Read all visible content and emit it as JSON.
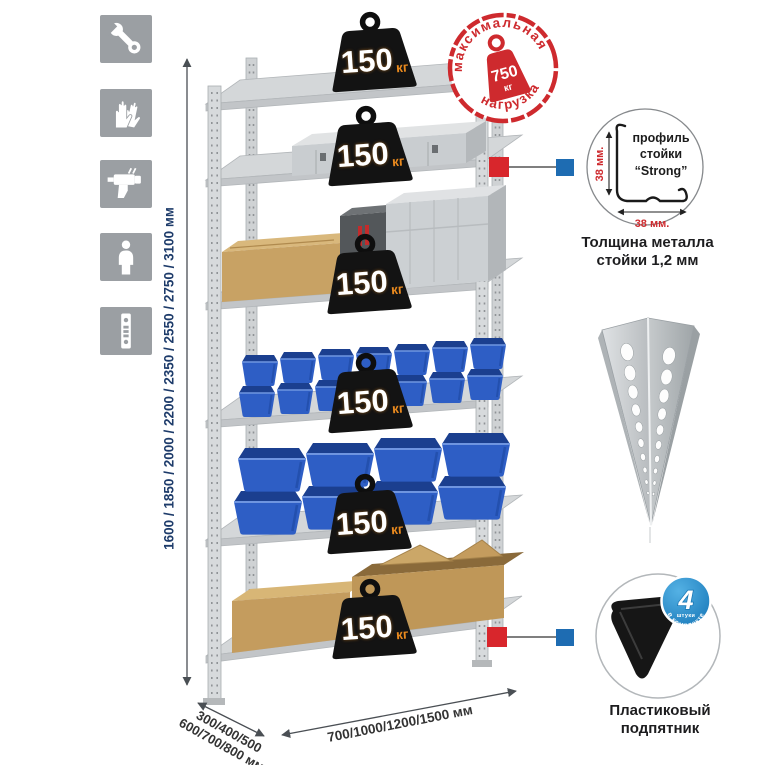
{
  "assembly_icons": {
    "items": [
      {
        "name": "wrench"
      },
      {
        "name": "gloves"
      },
      {
        "name": "drill"
      },
      {
        "name": "person"
      },
      {
        "name": "perforated-profile"
      }
    ]
  },
  "rack": {
    "shelf_count": 6,
    "badges": [
      {
        "value": "150",
        "unit": "кг"
      },
      {
        "value": "150",
        "unit": "кг"
      },
      {
        "value": "150",
        "unit": "кг"
      },
      {
        "value": "150",
        "unit": "кг"
      },
      {
        "value": "150",
        "unit": "кг"
      },
      {
        "value": "150",
        "unit": "кг"
      }
    ]
  },
  "stamp": {
    "arc_top": "максимальная",
    "arc_bottom": "нагрузка",
    "weight_value": "750",
    "weight_unit": "кг"
  },
  "dimensions": {
    "height_label": "1600 / 1850 / 2000 / 2200 / 2350 / 2550 / 2750 / 3100 мм",
    "depth_line1": "300/400/500",
    "depth_line2": "600/700/800 мм",
    "width_label": "700/1000/1200/1500 мм"
  },
  "profile_detail": {
    "word1": "профиль",
    "word2": "стойки",
    "word3": "“Strong”",
    "dim_vertical": "38 мм.",
    "dim_horizontal": "38 мм.",
    "caption_line1": "Толщина металла",
    "caption_line2": "стойки 1,2 мм"
  },
  "foot": {
    "badge_number": "4",
    "badge_small": "штуки",
    "badge_arc": "в комплекте",
    "caption_line1": "Пластиковый",
    "caption_line2": "подпятник"
  },
  "colors": {
    "stamp_red": "#ce2a2e",
    "accent_red": "#d8262c",
    "accent_blue": "#1e6cb2",
    "badge_blue": "#1f83c6",
    "bin_blue": "#2e5ec5",
    "dimension_navy": "#1d3b6a",
    "badge_black": "#131313",
    "unit_orange": "#e8891e",
    "metal_gray": "#d2d5d7",
    "cardboard": "#c8a264"
  }
}
